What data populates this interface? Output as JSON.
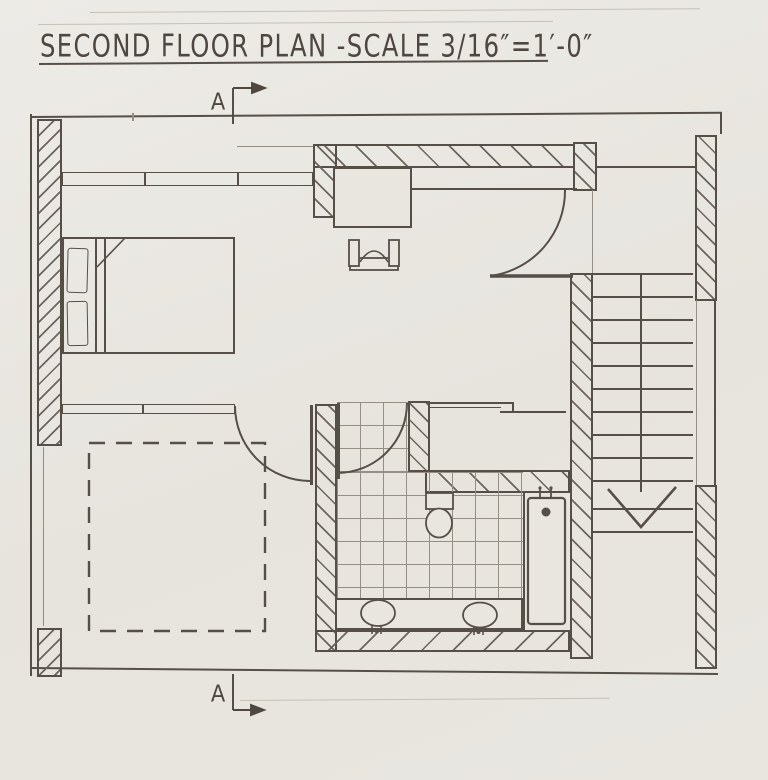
{
  "meta": {
    "paper_color": "#e9e6e0",
    "ink_color": "#564f48",
    "pencil_color": "#958e84"
  },
  "title": {
    "text": "SECOND FLOOR PLAN -SCALE 3/16″=1′-0″"
  },
  "section_markers": {
    "top_label": "A",
    "bottom_label": "A"
  }
}
